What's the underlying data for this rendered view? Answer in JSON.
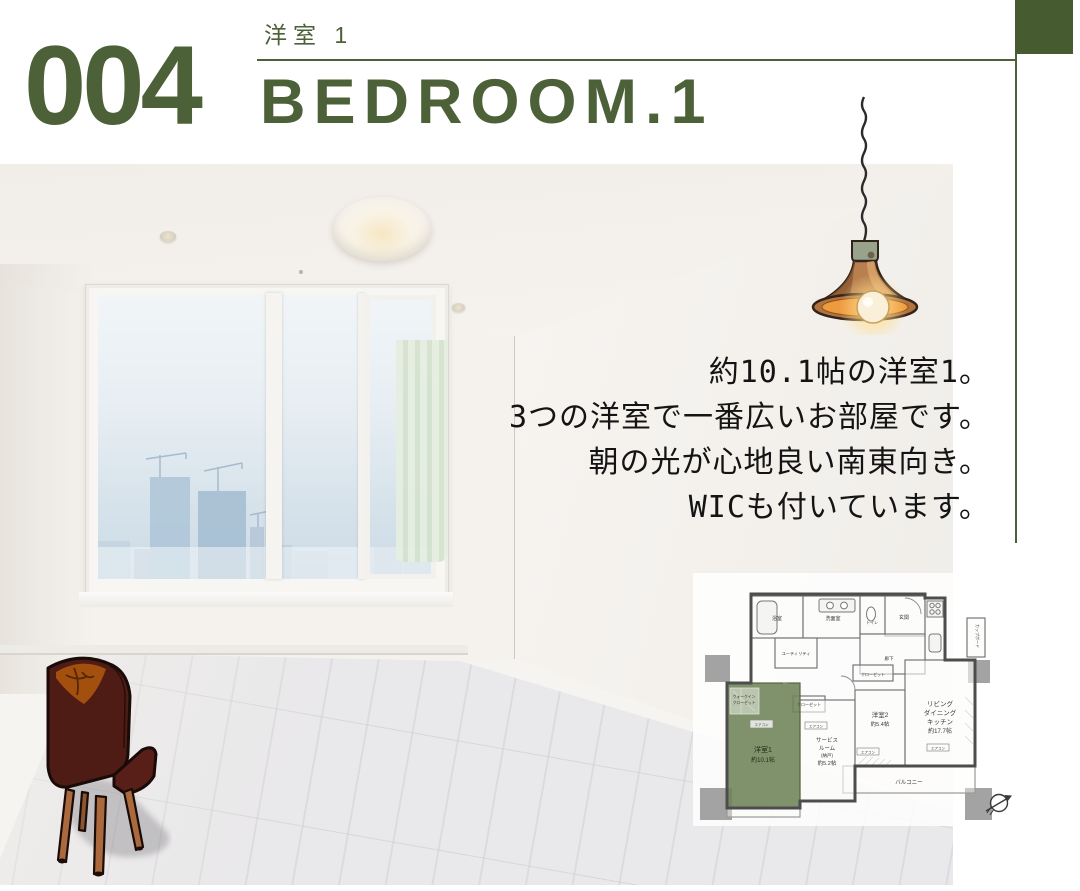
{
  "colors": {
    "accent_green": "#4d6138",
    "corner_square_green": "#475b30",
    "plan_highlight_green": "#6e8357",
    "text_black": "#141414"
  },
  "icons": {
    "pendant_lamp": "pendant-lamp-illustration",
    "chair": "vintage-chair-illustration",
    "north_arrow": "north-arrow-icon"
  },
  "header": {
    "index_number": "004",
    "room_label_jp": "洋室 1",
    "room_label_en": "BEDROOM.1"
  },
  "description": {
    "line1": "約10.1帖の洋室1。",
    "line2": "3つの洋室で一番広いお部屋です。",
    "line3": "朝の光が心地良い南東向き。",
    "line4": "WICも付いています。"
  },
  "floor_plan": {
    "labels": {
      "bath": "浴室",
      "washroom": "洗面室",
      "toilet": "トイレ",
      "entrance": "玄関",
      "hallway": "廊下",
      "utility": "ユーティリティ",
      "cupboard": "カップボード",
      "wic_line1": "ウォークイン",
      "wic_line2": "クローゼット",
      "closet1": "クローゼット",
      "closet2": "クローゼット",
      "ac": "エアコン",
      "bedroom1_name": "洋室1",
      "bedroom1_size": "約10.1帖",
      "service_line1": "サービス",
      "service_line2": "ルーム",
      "service_line3": "(納戸)",
      "service_line4": "約5.2帖",
      "bedroom2_name": "洋室2",
      "bedroom2_size": "約5.4帖",
      "ldk_line1": "リビング",
      "ldk_line2": "ダイニング",
      "ldk_line3": "キッチン",
      "ldk_line4": "約17.7帖",
      "balcony": "バルコニー"
    }
  }
}
